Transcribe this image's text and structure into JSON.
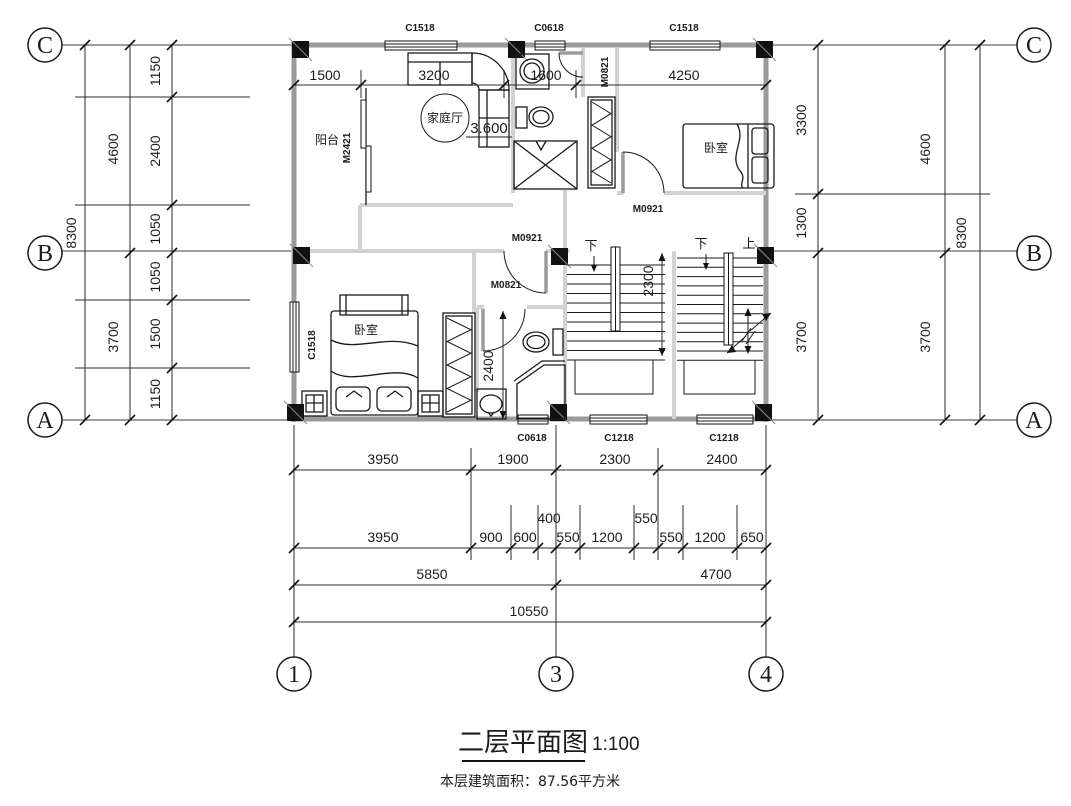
{
  "title": {
    "text": "二层平面图",
    "scale": "1:100",
    "area_note": "本层建筑面积：87.56平方米"
  },
  "grid_bubbles": {
    "left": [
      "C",
      "B",
      "A"
    ],
    "right": [
      "C",
      "B",
      "A"
    ],
    "bottom": [
      "1",
      "3",
      "4"
    ]
  },
  "rooms": {
    "balcony": "阳台",
    "family_room": "家庭厅",
    "family_elevation": "3.600",
    "bedroom_top": "卧室",
    "bedroom_bottom": "卧室"
  },
  "stairs": {
    "left_down": "下",
    "right_down": "下",
    "right_up": "上"
  },
  "door_labels": {
    "balcony": "M2421",
    "bath_top": "M0821",
    "bedroom_top": "M0921",
    "hall": "M0921",
    "bath_bottom": "M0821"
  },
  "window_labels": {
    "top": [
      "C1518",
      "C0618",
      "C1518"
    ],
    "left": "C1518",
    "bottom": [
      "C0618",
      "C1218",
      "C1218"
    ]
  },
  "dims": {
    "top": [
      "1500",
      "3200",
      "1600",
      "4250"
    ],
    "left_inner": [
      "1150",
      "2400",
      "1050",
      "1050",
      "1500",
      "1150"
    ],
    "left_middle": [
      "4600",
      "3700"
    ],
    "left_outer": "8300",
    "right_inner": [
      "3300",
      "1300",
      "3700"
    ],
    "right_middle": [
      "4600",
      "3700"
    ],
    "right_outer": "8300",
    "bottom_row1": [
      "3950",
      "1900",
      "2300",
      "2400"
    ],
    "bottom_row2": [
      "3950",
      "900",
      "600",
      "400",
      "550",
      "1200",
      "550",
      "550",
      "1200",
      "650"
    ],
    "bottom_row3": [
      "5850",
      "4700"
    ],
    "bottom_row4": "10550",
    "stair_depth": "2300",
    "bath_depth": "2400"
  }
}
